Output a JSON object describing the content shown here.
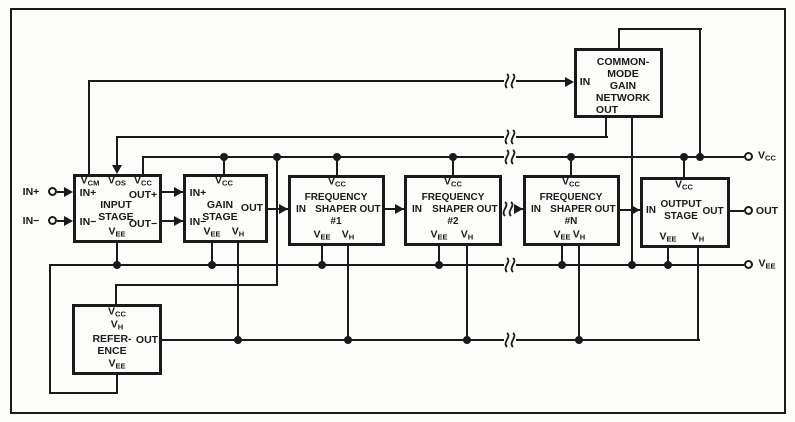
{
  "colors": {
    "ink": "#1a1a1a",
    "background": "#fcfcfa"
  },
  "terminals": {
    "in_plus": "IN+",
    "in_minus": "IN−",
    "vcc": "V_CC",
    "out": "OUT",
    "vee": "V_EE"
  },
  "blocks": {
    "input": {
      "name": "INPUT\nSTAGE",
      "pin_vcm": "V_CM",
      "pin_vos": "V_OS",
      "pin_vcc": "V_CC",
      "pin_in_plus": "IN+",
      "pin_in_minus": "IN−",
      "pin_out_plus": "OUT+",
      "pin_out_minus": "OUT−",
      "pin_vee": "V_EE"
    },
    "gain": {
      "name": "GAIN\nSTAGE",
      "pin_vcc": "V_CC",
      "pin_in_plus": "IN+",
      "pin_in_minus": "IN−",
      "pin_out": "OUT",
      "pin_vee": "V_EE",
      "pin_vh": "V_H"
    },
    "shaper1": {
      "name": "FREQUENCY\nSHAPER\n#1",
      "pin_vcc": "V_CC",
      "pin_in": "IN",
      "pin_out": "OUT",
      "pin_vee": "V_EE",
      "pin_vh": "V_H"
    },
    "shaper2": {
      "name": "FREQUENCY\nSHAPER\n#2",
      "pin_vcc": "V_CC",
      "pin_in": "IN",
      "pin_out": "OUT",
      "pin_vee": "V_EE",
      "pin_vh": "V_H"
    },
    "shaperN": {
      "name": "FREQUENCY\nSHAPER\n#N",
      "pin_vcc": "V_CC",
      "pin_in": "IN",
      "pin_out": "OUT",
      "pin_vee": "V_EE",
      "pin_vh": "V_H"
    },
    "output": {
      "name": "OUTPUT\nSTAGE",
      "pin_vcc": "V_CC",
      "pin_in": "IN",
      "pin_out": "OUT",
      "pin_vee": "V_EE",
      "pin_vh": "V_H"
    },
    "common_mode": {
      "name": "COMMON-\nMODE\nGAIN\nNETWORK",
      "pin_in": "IN",
      "pin_out": "OUT"
    },
    "reference": {
      "pin_vcc": "V_CC",
      "pin_vh": "V_H",
      "name": "REFER-\nENCE",
      "pin_out": "OUT",
      "pin_vee": "V_EE"
    }
  }
}
